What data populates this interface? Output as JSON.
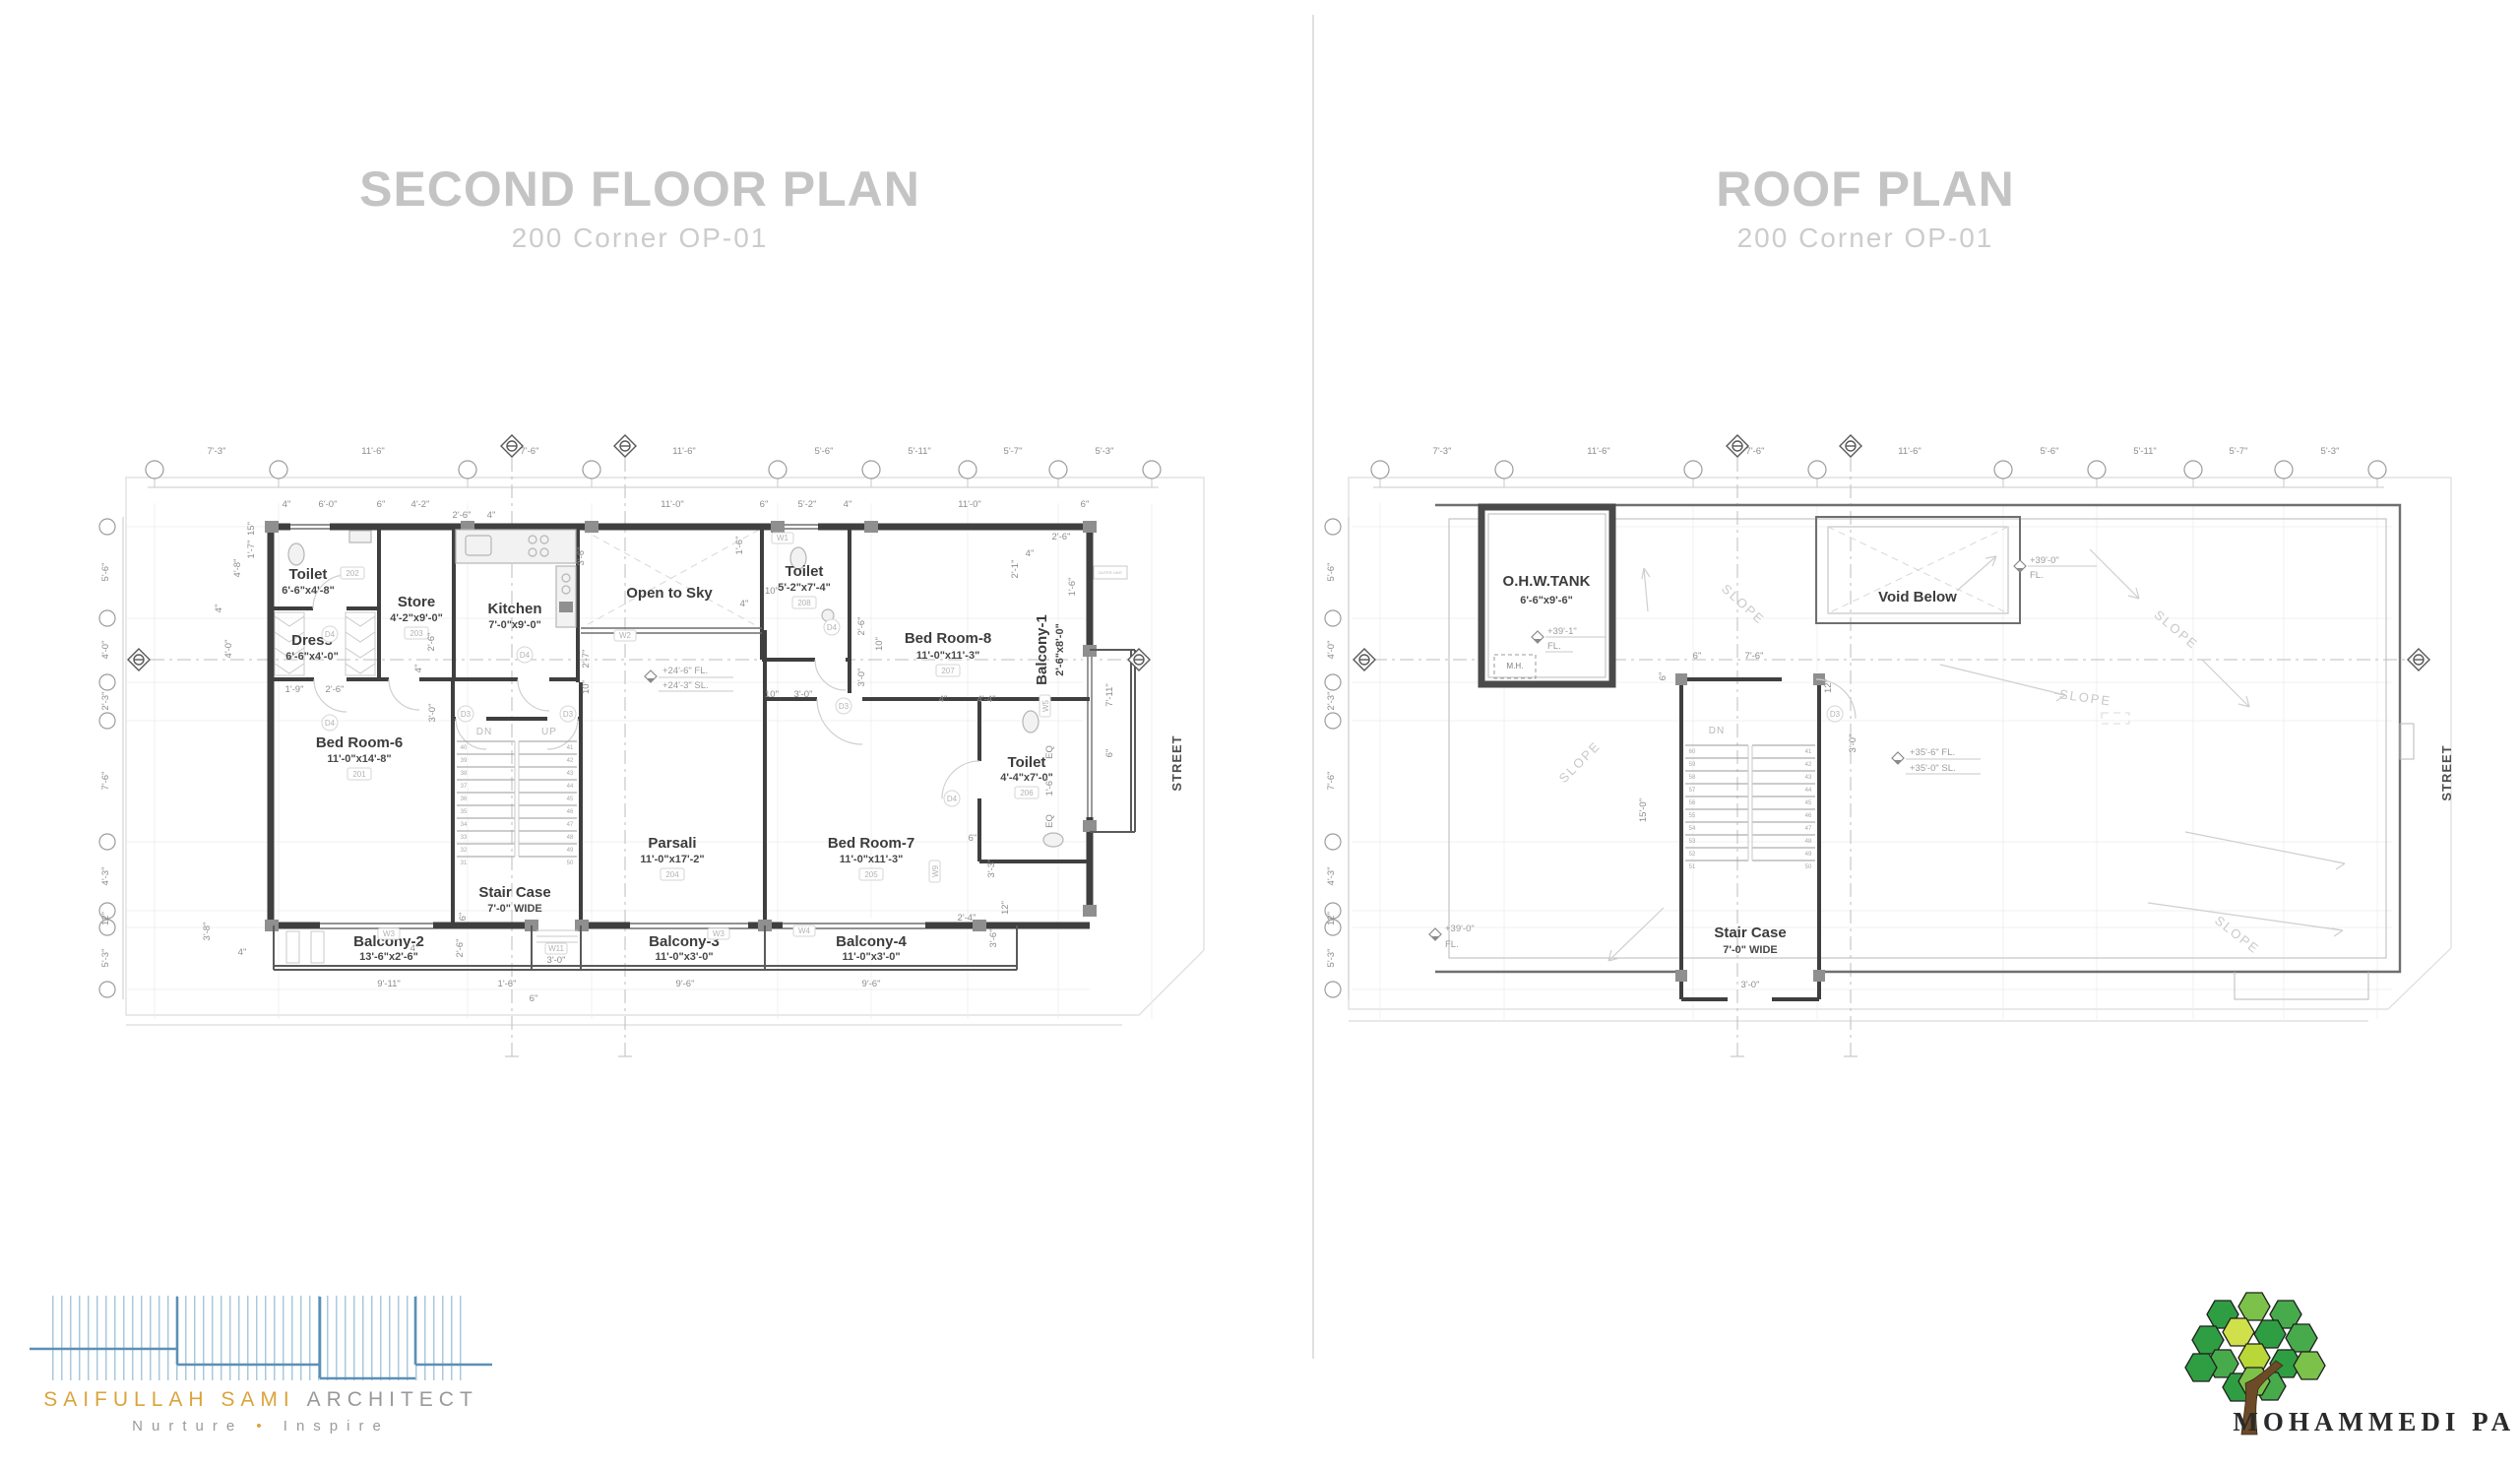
{
  "left_plan": {
    "title": "SECOND FLOOR PLAN",
    "subtitle": "200 Corner OP-01",
    "street_label": "STREET",
    "rooms": [
      {
        "name": "Toilet",
        "size": "6'-6\"x4'-8\"",
        "tag": "202"
      },
      {
        "name": "Store",
        "size": "4'-2\"x9'-0\"",
        "tag": "203"
      },
      {
        "name": "Kitchen",
        "size": "7'-0\"x9'-0\"",
        "tag": ""
      },
      {
        "name": "Open to Sky",
        "size": "",
        "tag": ""
      },
      {
        "name": "Toilet",
        "size": "5'-2\"x7'-4\"",
        "tag": "208"
      },
      {
        "name": "Bed Room-8",
        "size": "11'-0\"x11'-3\"",
        "tag": "207"
      },
      {
        "name": "Balcony-1",
        "size": "2'-6\"x8'-0\"",
        "tag": ""
      },
      {
        "name": "Dress",
        "size": "6'-6\"x4'-0\"",
        "tag": ""
      },
      {
        "name": "Bed Room-6",
        "size": "11'-0\"x14'-8\"",
        "tag": "201"
      },
      {
        "name": "Stair Case",
        "size": "7'-0\" WIDE",
        "tag": ""
      },
      {
        "name": "Parsali",
        "size": "11'-0\"x17'-2\"",
        "tag": "204"
      },
      {
        "name": "Bed Room-7",
        "size": "11'-0\"x11'-3\"",
        "tag": "205"
      },
      {
        "name": "Toilet",
        "size": "4'-4\"x7'-0\"",
        "tag": "206"
      },
      {
        "name": "Balcony-2",
        "size": "13'-6\"x2'-6\"",
        "tag": ""
      },
      {
        "name": "Balcony-3",
        "size": "11'-0\"x3'-0\"",
        "tag": ""
      },
      {
        "name": "Balcony-4",
        "size": "11'-0\"x3'-0\"",
        "tag": ""
      }
    ],
    "grid_dims_top": [
      "7'-3\"",
      "11'-6\"",
      "7'-6\"",
      "11'-6\"",
      "5'-6\"",
      "5'-11\"",
      "5'-7\"",
      "5'-3\""
    ],
    "grid_dims_left": [
      "5'-6\"",
      "4'-0\"",
      "2'-3\"",
      "7'-6\"",
      "4'-3\"",
      "12\"",
      "5'-3\""
    ],
    "small_dims": [
      "4\"",
      "6'-0\"",
      "6\"",
      "4'-2\"",
      "2'-6\"",
      "4\"",
      "11'-0\"",
      "6\"",
      "5'-2\"",
      "4\"",
      "11'-0\"",
      "6\"",
      "15\"",
      "1'-7\"",
      "4'-8\"",
      "4\"",
      "4'-0\"",
      "1'-9\"",
      "2'-6\"",
      "3'-6\"",
      "2'-7\"",
      "10\"",
      "2'-6\"",
      "4\"",
      "3'-0\"",
      "1'-6\"",
      "4\"",
      "10\"",
      "2'-6\"",
      "10\"",
      "3'-0\"",
      "10\"",
      "3'-0\"",
      "4\"",
      "4'-4\"",
      "2'-6\"",
      "4\"",
      "2'-1\"",
      "1'-6\"",
      "7'-11\"",
      "6\"",
      "EQ",
      "1'-6\"",
      "EQ",
      "3'-3\"",
      "12\"",
      "2'-4\"",
      "3'-6\"",
      "6\"",
      "6\"",
      "2'-6\"",
      "4\"",
      "4\"",
      "3'-8\"",
      "9'-11\"",
      "1'-6\"",
      "3'-0\"",
      "6\"",
      "9'-6\"",
      "9'-6\""
    ],
    "door_tags": [
      "D4",
      "D4",
      "D4",
      "D3",
      "D3",
      "D4",
      "D3",
      "D4"
    ],
    "window_tags": [
      "W1",
      "W2",
      "W3",
      "W11",
      "W3",
      "W4",
      "W5",
      "W9"
    ],
    "stair": {
      "dn": "DN",
      "up": "UP",
      "left_risers": [
        "40",
        "39",
        "38",
        "37",
        "36",
        "35",
        "34",
        "33",
        "32",
        "31"
      ],
      "right_risers": [
        "41",
        "42",
        "43",
        "44",
        "45",
        "46",
        "47",
        "48",
        "49",
        "50"
      ]
    },
    "elevation": {
      "fl": "+24'-6\" FL.",
      "sl": "+24'-3\" SL."
    },
    "outer_unit": "OUTER UNIT"
  },
  "roof_plan": {
    "title": "ROOF PLAN",
    "subtitle": "200 Corner OP-01",
    "street_label": "STREET",
    "tank": {
      "name": "O.H.W.TANK",
      "size": "6'-6\"x9'-6\"",
      "elev": "+39'-1\"",
      "fl": "FL.",
      "mh": "M.H."
    },
    "void_label": "Void Below",
    "stair": {
      "name": "Stair Case",
      "size": "7'-0\" WIDE",
      "dn": "DN",
      "left_risers": [
        "60",
        "59",
        "58",
        "57",
        "56",
        "55",
        "54",
        "53",
        "52",
        "51"
      ],
      "right_risers": [
        "41",
        "42",
        "43",
        "44",
        "45",
        "46",
        "47",
        "48",
        "49",
        "50"
      ]
    },
    "slope_label": "SLOPE",
    "elevations": {
      "roof_fl": "+39'-0\"",
      "fl": "FL.",
      "mid_fl": "+35'-6\" FL.",
      "mid_sl": "+35'-0\" SL."
    },
    "grid_dims_top": [
      "7'-3\"",
      "11'-6\"",
      "7'-6\"",
      "11'-6\"",
      "5'-6\"",
      "5'-11\"",
      "5'-7\"",
      "5'-3\""
    ],
    "grid_dims_left": [
      "5'-6\"",
      "4'-0\"",
      "2'-3\"",
      "7'-6\"",
      "4'-3\"",
      "12\"",
      "5'-3\""
    ],
    "small_dims": [
      "6\"",
      "7'-6\"",
      "6\"",
      "12\"",
      "3'-0\"",
      "15'-0\"",
      "3'-0\""
    ],
    "door_tag": "D3"
  },
  "footer": {
    "architect": {
      "name_accent": "SAIFULLAH SAMI",
      "name_rest": "ARCHITECT",
      "tagline_a": "Nurture",
      "bullet": "•",
      "tagline_b": "Inspire"
    },
    "park": {
      "name": "MOHAMMEDI PARK"
    }
  },
  "colors": {
    "accent_gold": "#dba43c",
    "logo_blue": "#5d8fb5",
    "title_gray": "#c4c4c4",
    "tree_greens": [
      "#2f9e43",
      "#47ab4b",
      "#7cc24a",
      "#b9d838",
      "#cfe04a"
    ]
  }
}
